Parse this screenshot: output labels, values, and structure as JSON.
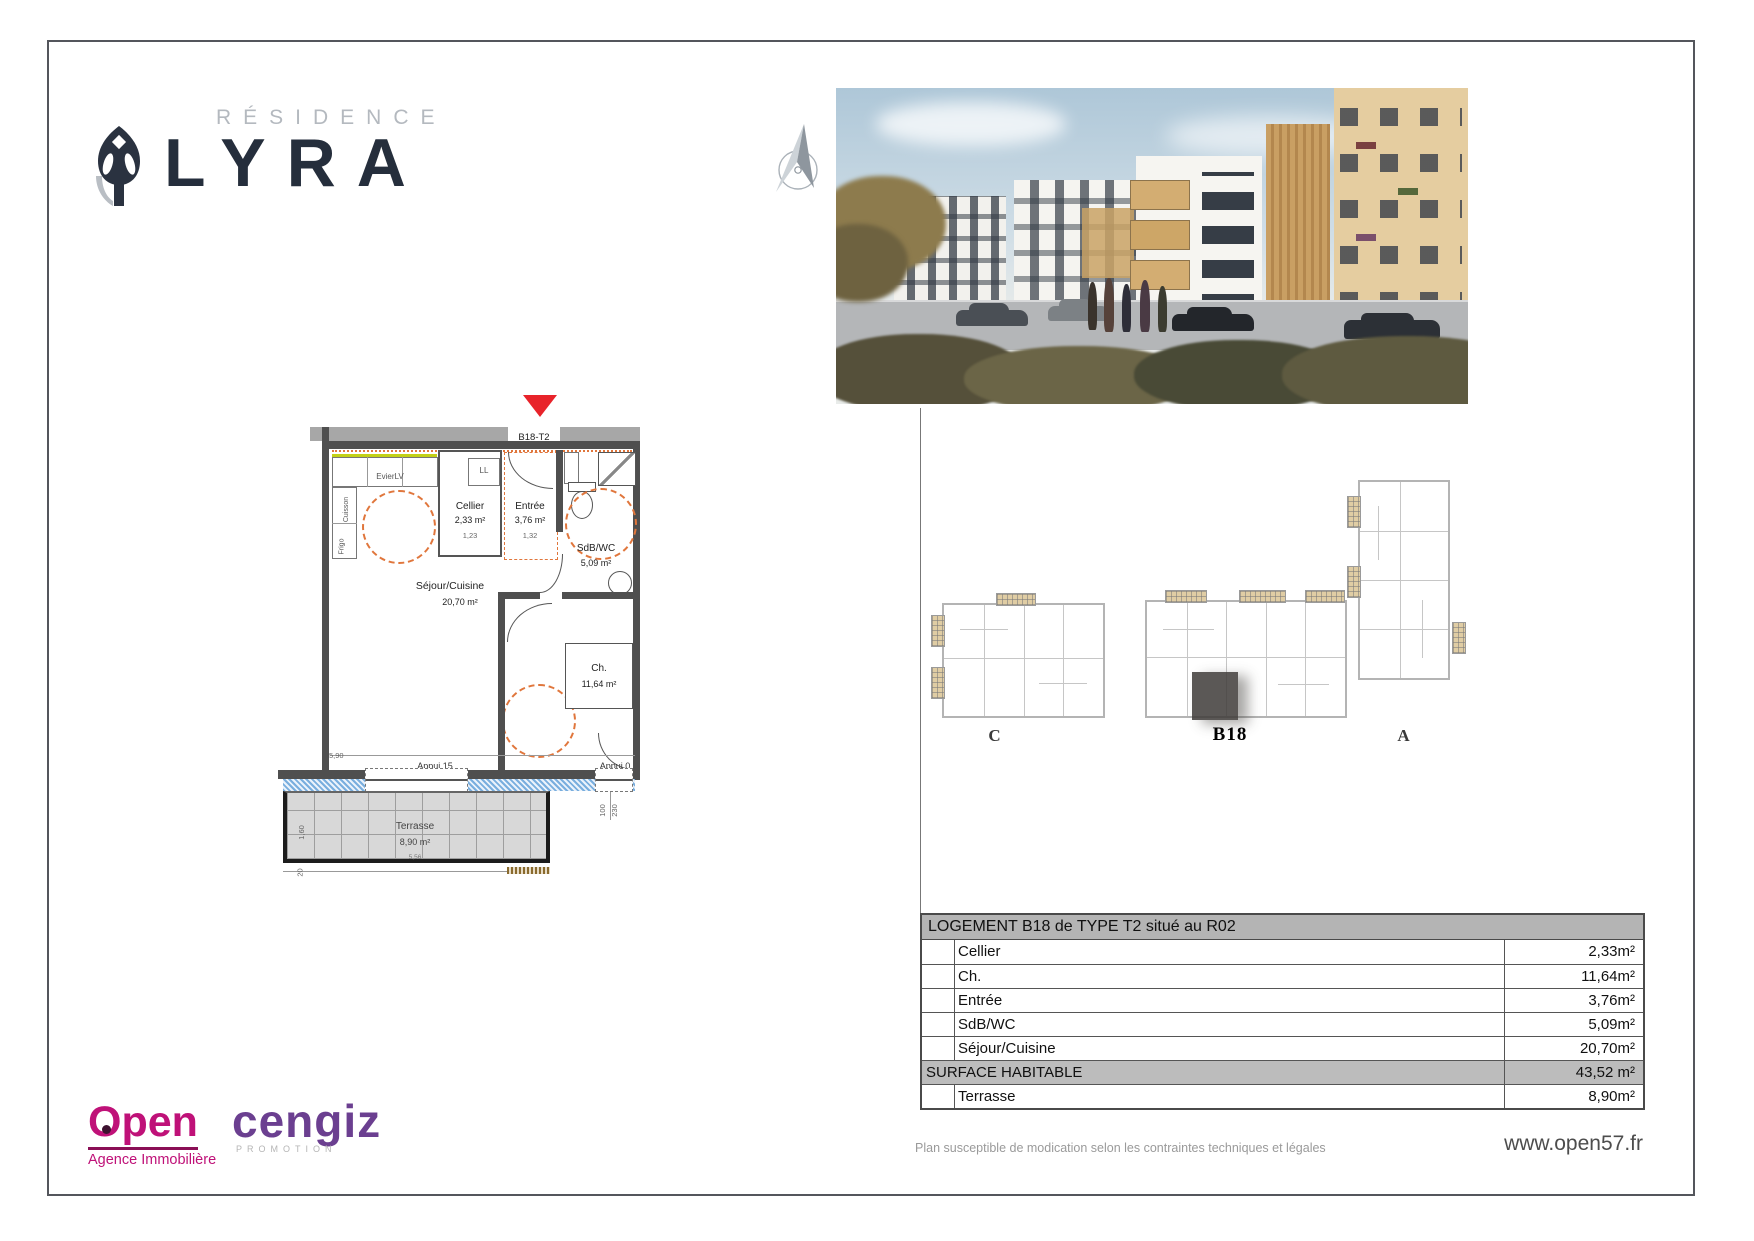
{
  "document": {
    "brand": {
      "residence_label": "RÉSIDENCE",
      "name": "LYRA"
    },
    "floorplan": {
      "unit_tag": "B18-T2",
      "labels": {
        "evier": "EvierLV",
        "ll": "LL",
        "cuisson": "Cuisson",
        "frigo": "Frigo",
        "cellier": "Cellier",
        "cellier_area": "2,33 m²",
        "cellier_dim": "1,23",
        "entree": "Entrée",
        "entree_area": "3,76 m²",
        "entree_dim": "1,32",
        "sdb": "SdB/WC",
        "sdb_area": "5,09 m²",
        "sejour": "Séjour/Cuisine",
        "sejour_area": "20,70 m²",
        "ch": "Ch.",
        "ch_area": "11,64 m²",
        "terrasse": "Terrasse",
        "terrasse_area": "8,90 m²",
        "terrasse_dim": "5,56",
        "appui15": "Appui 15",
        "appui0": "Appui 0",
        "dim_590": "5,90",
        "dim_220": "220",
        "dim_215": "215",
        "dim_100": "100",
        "dim_230": "230",
        "dim_160": "1,60",
        "dim_20": "20"
      }
    },
    "siteplans": {
      "c": "C",
      "b18": "B18",
      "a": "A"
    },
    "table": {
      "header": "LOGEMENT B18 de TYPE T2 situé au R02",
      "rows": [
        {
          "label": "Cellier",
          "value": "2,33m²"
        },
        {
          "label": "Ch.",
          "value": "11,64m²"
        },
        {
          "label": "Entrée",
          "value": "3,76m²"
        },
        {
          "label": "SdB/WC",
          "value": "5,09m²"
        },
        {
          "label": "Séjour/Cuisine",
          "value": "20,70m²"
        }
      ],
      "surface_label": "SURFACE HABITABLE",
      "surface_value": "43,52 m²",
      "terrace_label": "Terrasse",
      "terrace_value": "8,90m²"
    },
    "footer": {
      "disclaimer": "Plan susceptible de modication selon les contraintes techniques et légales",
      "website": "www.open57.fr"
    },
    "partners": {
      "open_name": "Open",
      "open_tagline": "Agence Immobilière",
      "cengiz_name": "cengiz",
      "cengiz_tagline": "PROMOTION"
    }
  }
}
